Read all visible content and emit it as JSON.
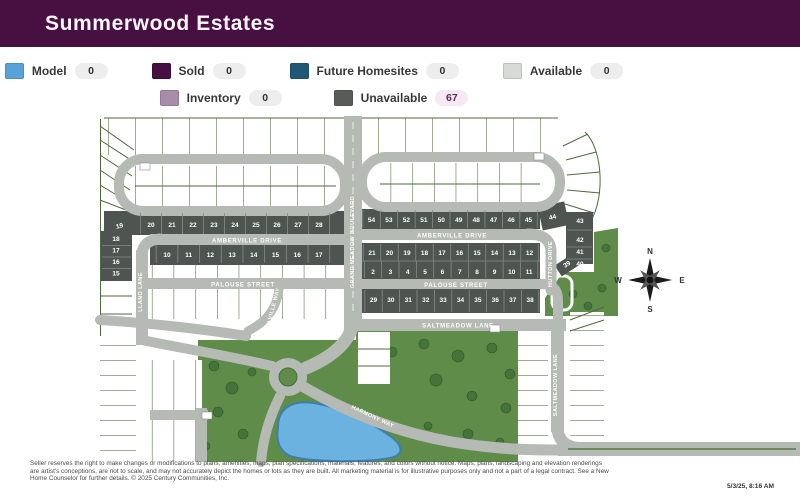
{
  "header": {
    "title": "Summerwood Estates",
    "bg_color": "#471041"
  },
  "legend": {
    "items": [
      {
        "label": "Model",
        "count": "0",
        "color": "#57a3d9"
      },
      {
        "label": "Sold",
        "count": "0",
        "color": "#470f42"
      },
      {
        "label": "Future Homesites",
        "count": "0",
        "color": "#1f5876"
      },
      {
        "label": "Available",
        "count": "0",
        "color": "#d7dad7"
      },
      {
        "label": "Inventory",
        "count": "0",
        "color": "#a98ca9"
      },
      {
        "label": "Unavailable",
        "count": "67",
        "color": "#575c59"
      }
    ]
  },
  "map": {
    "streets": {
      "amberville": "AMBERVILLE DRIVE",
      "palouse": "PALOUSE STREET",
      "grand_meadow": "GRAND MEADOW BOULEVARD",
      "llano": "LLANO LANE",
      "melville": "MELVILLE WAY",
      "hutton": "HUTTON DRIVE",
      "saltmeadow": "SALTMEADOW LANE",
      "harmony": "HARMONY WAY"
    },
    "compass": {
      "north": "N",
      "south": "S",
      "east": "E",
      "west": "W"
    },
    "lot_rows": [
      {
        "id": "left-top",
        "y": 227,
        "x0": 151,
        "step": 21,
        "sep": [
          213,
          234
        ],
        "numbers": [
          "20",
          "21",
          "22",
          "23",
          "24",
          "25",
          "26",
          "27",
          "28"
        ]
      },
      {
        "id": "lot-19",
        "singles": [
          {
            "n": "19",
            "x": 120,
            "y": 228,
            "rot": -14
          }
        ]
      },
      {
        "id": "left-col",
        "x": 116,
        "ys": [
          241,
          252.5,
          264,
          275.5
        ],
        "sepYs": [
          245.5,
          257,
          268.5
        ],
        "sepX": [
          102,
          131
        ],
        "numbers": [
          "18",
          "17",
          "16",
          "15"
        ]
      },
      {
        "id": "left-mid",
        "y": 257,
        "x0": 167,
        "step": 21.7,
        "sep": [
          245,
          263
        ],
        "numbers": [
          "10",
          "11",
          "12",
          "13",
          "14",
          "15",
          "16",
          "17"
        ]
      },
      {
        "id": "right-top",
        "y": 222,
        "x0": 371.5,
        "step": 17.45,
        "sep": [
          210,
          228
        ],
        "numbers": [
          "54",
          "53",
          "52",
          "51",
          "50",
          "49",
          "48",
          "47",
          "46",
          "45"
        ]
      },
      {
        "id": "lot-44-39",
        "singles": [
          {
            "n": "44",
            "x": 553,
            "y": 219,
            "rot": -13
          },
          {
            "n": "39",
            "x": 568,
            "y": 266,
            "rot": -33
          }
        ]
      },
      {
        "id": "right-col",
        "x": 580,
        "ys": [
          223,
          242,
          254,
          266
        ],
        "sepYs": [
          230,
          247,
          259
        ],
        "sepX": [
          567,
          592
        ],
        "numbers": [
          "43",
          "42",
          "41",
          "40"
        ]
      },
      {
        "id": "right-r2",
        "y": 255,
        "x0": 372,
        "step": 17.5,
        "sep": [
          244,
          260.5
        ],
        "numbers": [
          "21",
          "20",
          "19",
          "18",
          "17",
          "16",
          "15",
          "14",
          "13",
          "12"
        ]
      },
      {
        "id": "right-r3",
        "y": 274,
        "x0": 373,
        "step": 17.35,
        "sep": [
          261.5,
          278
        ],
        "numbers": [
          "2",
          "3",
          "4",
          "5",
          "6",
          "7",
          "8",
          "9",
          "10",
          "11"
        ]
      },
      {
        "id": "right-r4",
        "y": 302,
        "x0": 373.5,
        "step": 17.4,
        "sep": [
          290,
          312
        ],
        "numbers": [
          "29",
          "30",
          "31",
          "32",
          "33",
          "34",
          "35",
          "36",
          "37",
          "38"
        ]
      }
    ]
  },
  "footer": {
    "disclaimer_lines": [
      "Seller reserves the right to make changes or modifications to plans, amenities, maps, plan specifications, materials, features, and colors without notice. Maps, plans, landscaping and elevation renderings",
      "are artist's conceptions, are not to scale, and may not accurately depict the homes or lots as they are built. All marketing material is for illustrative purposes only and not a part of a legal contract. See a New",
      "Home Counselor for further details. © 2025 Century Communities, Inc."
    ],
    "timestamp": "5/3/25, 8:16 AM"
  }
}
